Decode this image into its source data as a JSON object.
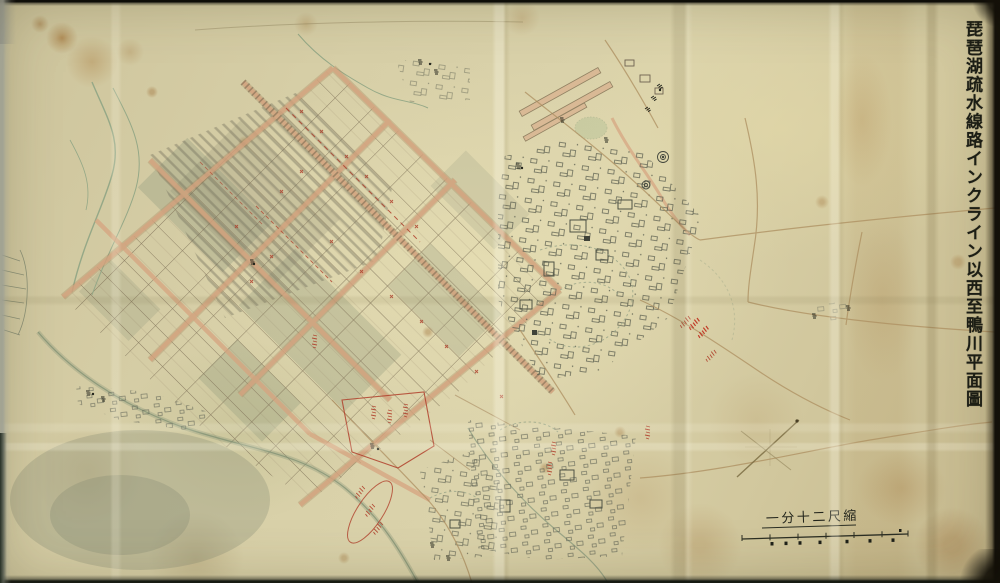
{
  "map": {
    "title": "琵琶湖疏水線路インクライン以西至鴨川平面圖",
    "scale_label": "一分十二尺縮"
  },
  "colors": {
    "paper": "#d5cba1",
    "stain_brown": "#a97b3c",
    "ink_black": "#23251c",
    "ink_red": "#b0402c",
    "road_pink": "#d6a37f",
    "river_green": "#92a484",
    "pencil_gray": "#6b705f",
    "frame_dark": "#0d0b07"
  }
}
